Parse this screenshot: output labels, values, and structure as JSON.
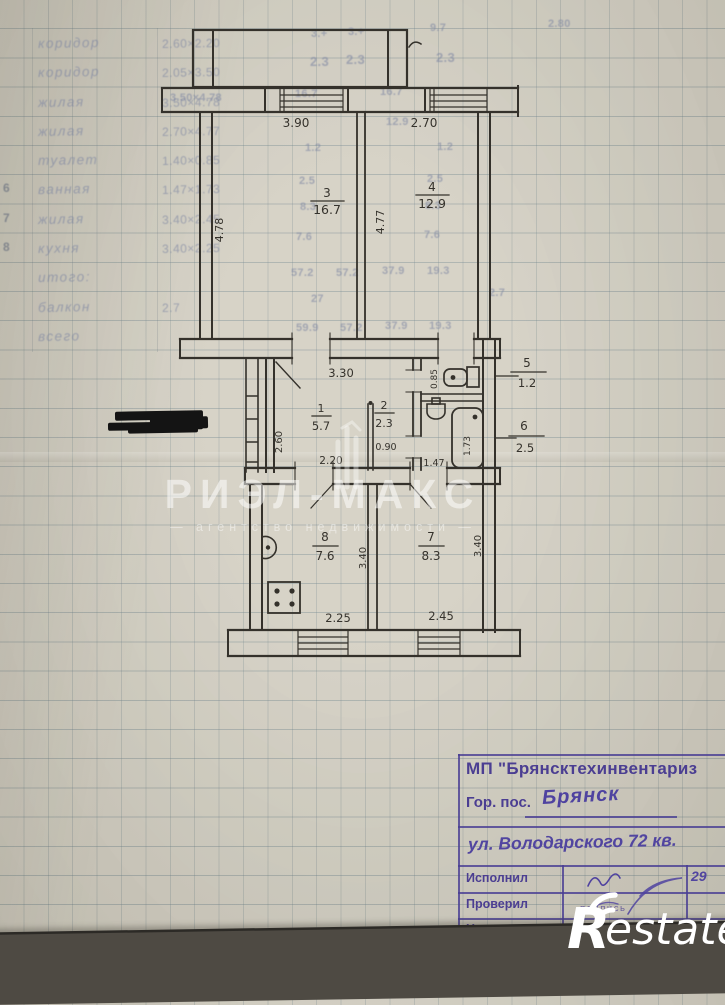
{
  "ghost_table": {
    "rows": [
      {
        "num": "",
        "name": "коридор",
        "dims": "2.60×2.20"
      },
      {
        "num": "",
        "name": "коридор",
        "dims": "2.05×3.50"
      },
      {
        "num": "",
        "name": "жилая",
        "dims": "3.50×4.78"
      },
      {
        "num": "",
        "name": "жилая",
        "dims": "2.70×4.77"
      },
      {
        "num": "",
        "name": "туалет",
        "dims": "1.40×0.85"
      },
      {
        "num": "6",
        "name": "ванная",
        "dims": "1.47×1.73"
      },
      {
        "num": "7",
        "name": "жилая",
        "dims": "3.40×2.45"
      },
      {
        "num": "8",
        "name": "кухня",
        "dims": "3.40×2.25"
      },
      {
        "num": "",
        "name": "итого:",
        "dims": ""
      },
      {
        "num": "",
        "name": "балкон",
        "dims": "2.7"
      },
      {
        "num": "",
        "name": "всего",
        "dims": ""
      }
    ]
  },
  "ghost_numbers": [
    "9.7",
    "2.80",
    "3.+",
    "3.+",
    "2.3",
    "2.3",
    "2.3",
    "16.7",
    "16.7",
    "12.9",
    "1.2",
    "1.2",
    "2.5",
    "2.5",
    "8.3",
    "8.3",
    "7.6",
    "7.6",
    "57.2",
    "57.2",
    "37.9",
    "19.3",
    "27",
    "2.7",
    "59.9",
    "57.2",
    "37.9",
    "19.3",
    "3.50×4.78"
  ],
  "plan": {
    "rooms": [
      {
        "number": "3",
        "area": "16.7"
      },
      {
        "number": "4",
        "area": "12.9"
      },
      {
        "number": "1",
        "area": "5.7"
      },
      {
        "number": "2",
        "area": "2.3"
      },
      {
        "number": "5",
        "area": "1.2"
      },
      {
        "number": "6",
        "area": "2.5"
      },
      {
        "number": "8",
        "area": "7.6"
      },
      {
        "number": "7",
        "area": "8.3"
      }
    ],
    "dims": {
      "w390": "3.90",
      "w270": "2.70",
      "h478": "4.78",
      "h477": "4.77",
      "w330": "3.30",
      "h260": "2.60",
      "w220": "2.20",
      "w090": "0.90",
      "h085": "0.85",
      "w147": "1.47",
      "h173": "1.73",
      "h340k": "3.40",
      "h340r": "3.40",
      "w225": "2.25",
      "w245": "2.45"
    }
  },
  "watermark": {
    "title": "РИЭЛ-МАКС",
    "subtitle": "—  агентство  недвижимости  —"
  },
  "restate": {
    "r": "R",
    "estate": "estate"
  },
  "stamp": {
    "org": "МП \"Брянсктехинвентариз",
    "city_label": "Гор. пос.",
    "city_value": "Брянск",
    "address": "ул. Володарского 72 кв.",
    "rows": [
      {
        "label": "Исполнил",
        "note": "",
        "right": "29"
      },
      {
        "label": "Проверил",
        "note": "подпись",
        "right": ""
      },
      {
        "label": "Нач.",
        "note": "",
        "right": ""
      }
    ]
  }
}
